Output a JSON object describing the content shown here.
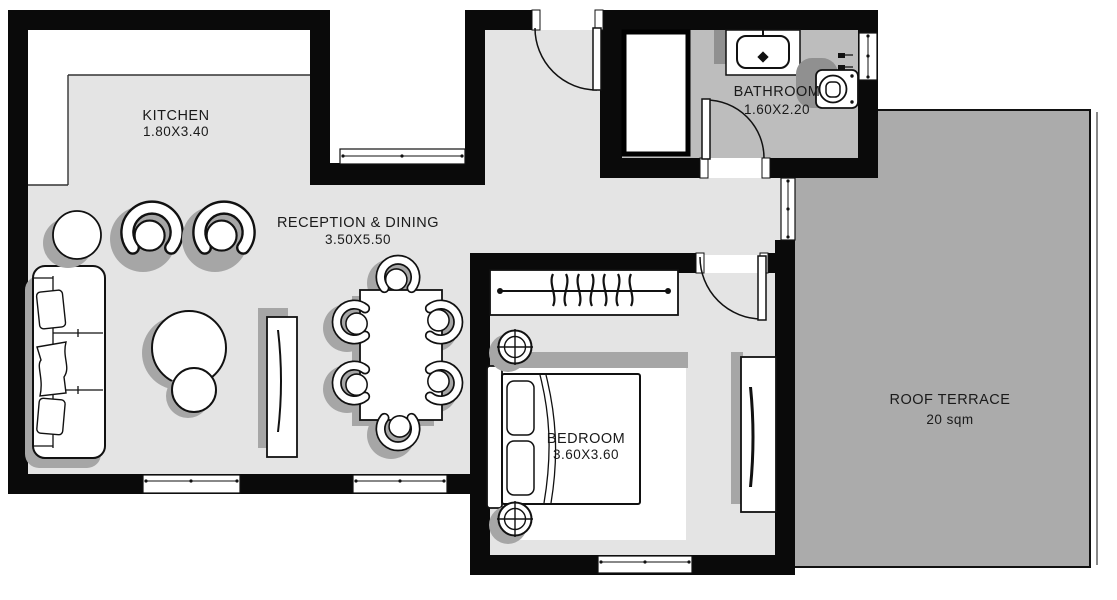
{
  "plan": {
    "rooms": {
      "kitchen": {
        "name": "KITCHEN",
        "dims": "1.80X3.40"
      },
      "reception_dining": {
        "name": "RECEPTION & DINING",
        "dims": "3.50X5.50"
      },
      "bathroom": {
        "name": "BATHROOM",
        "dims": "1.60X2.20"
      },
      "bedroom": {
        "name": "BEDROOM",
        "dims": "3.60X3.60"
      },
      "roof_terrace": {
        "name": "ROOF TERRACE",
        "dims": "20 sqm"
      }
    },
    "colors": {
      "wall": "#0a0a0a",
      "interior_floor": "#e4e4e4",
      "bathroom_floor": "#bdbdbd",
      "terrace_floor": "#ababab",
      "furniture_fill": "#ffffff",
      "furniture_line": "#111111",
      "shadow": "#a6a6a6",
      "text": "#1a1a1a",
      "background": "#ffffff"
    }
  }
}
